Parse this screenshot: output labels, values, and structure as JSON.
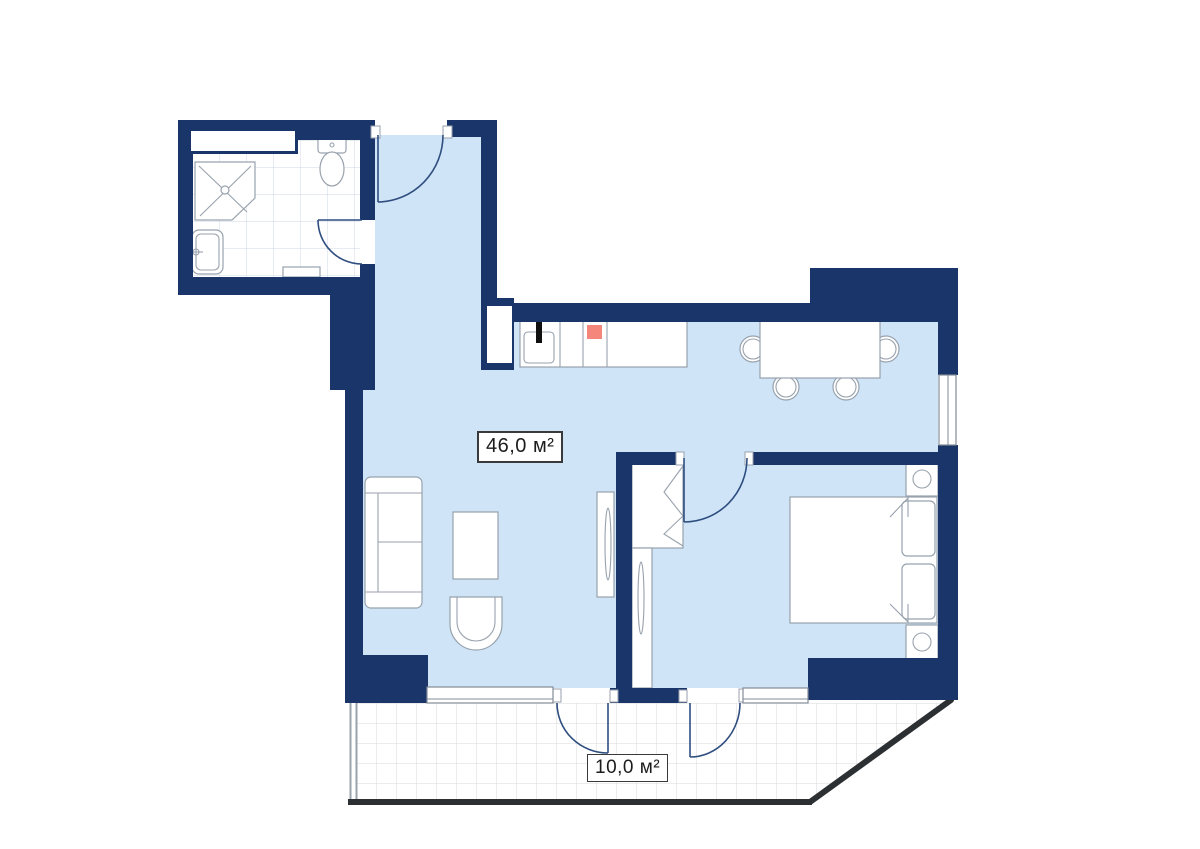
{
  "labels": {
    "living_area": "46,0 м²",
    "balcony_area": "10,0 м²"
  },
  "colors": {
    "wall": "#1a356a",
    "floor": "#cfe4f7",
    "outline": "#98a2ad",
    "door": "#2f4e80",
    "stove": "#f4867b",
    "frame": "#828c97",
    "rail": "#2c3033",
    "tile-bath": "#cfd9e4",
    "tile-balcony": "#dadada"
  }
}
